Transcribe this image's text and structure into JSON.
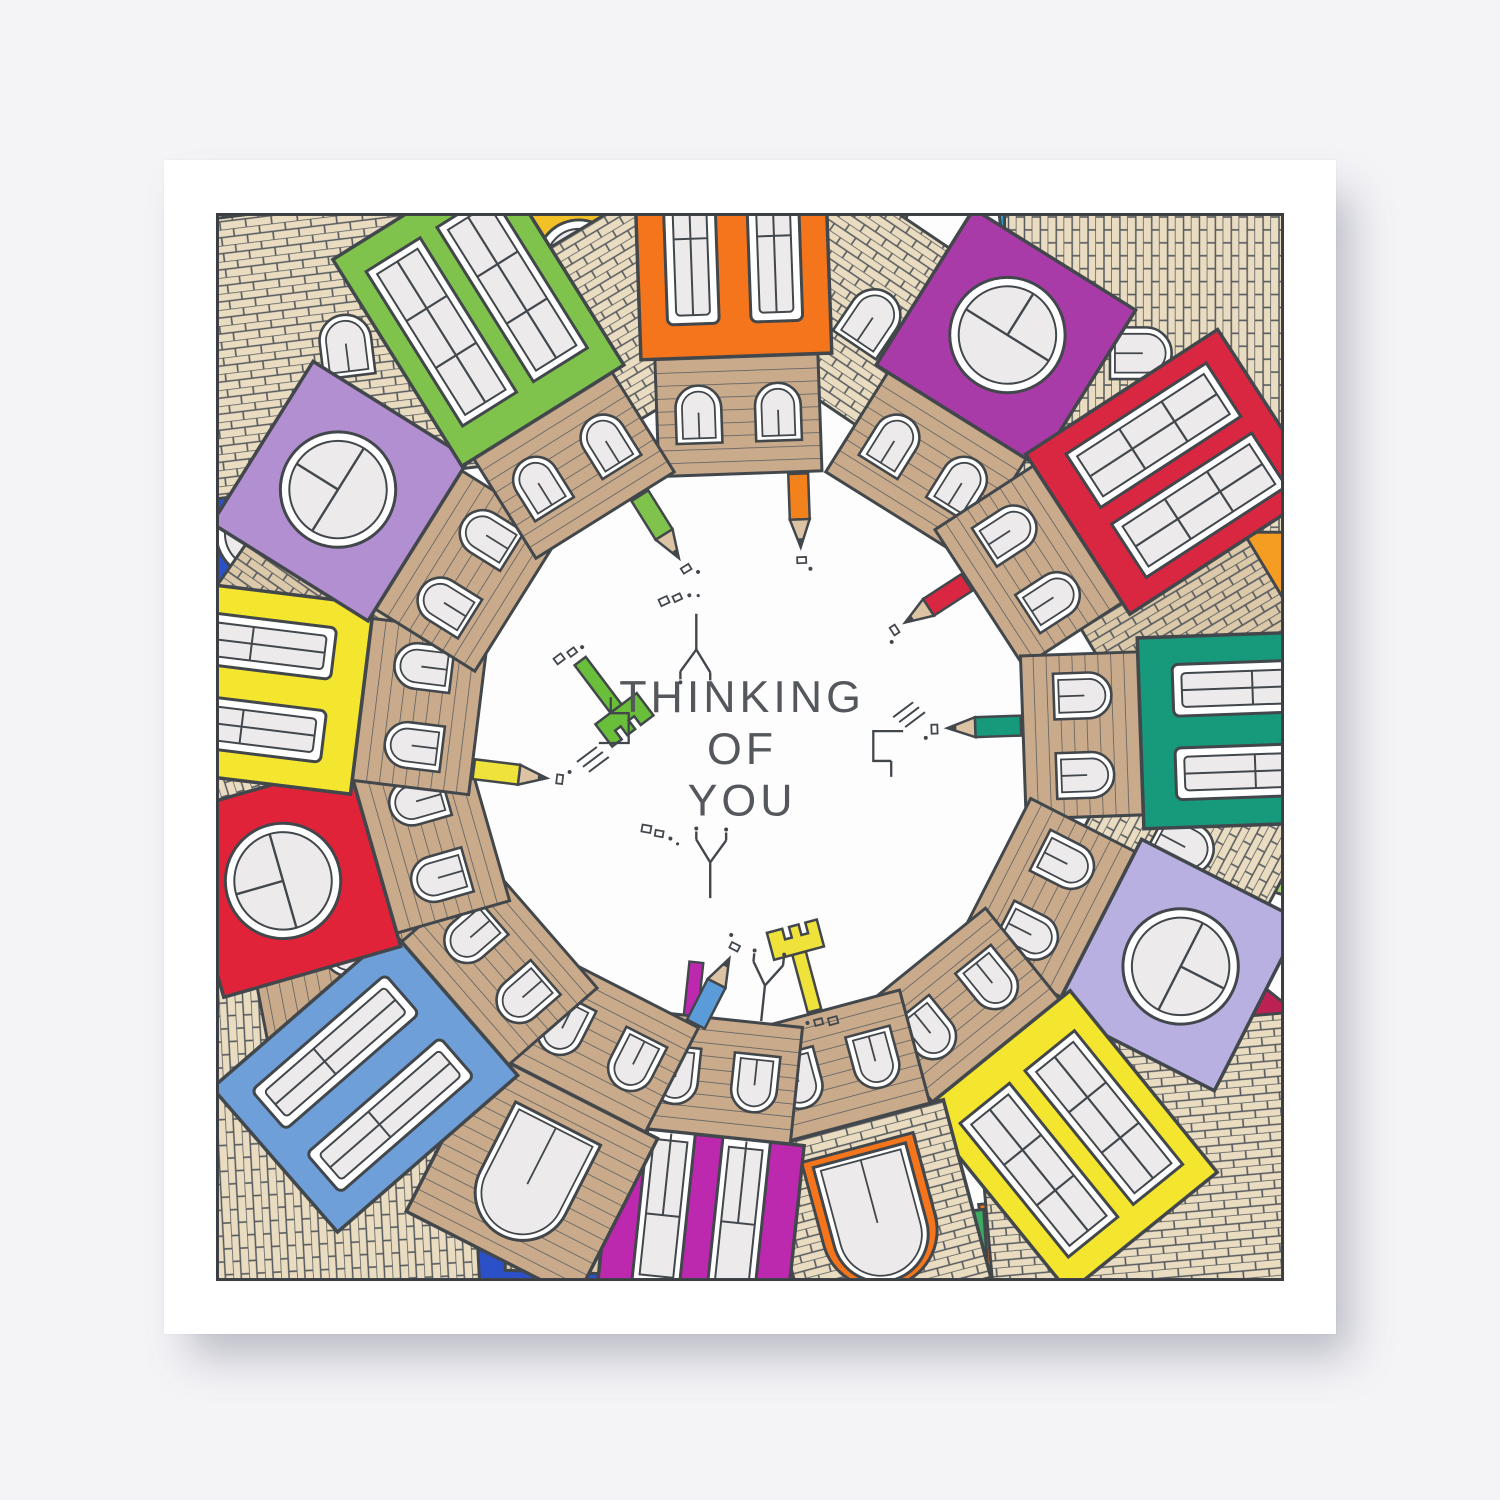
{
  "photo": {
    "background": "#f4f4f7",
    "card_color": "#ffffff"
  },
  "card": {
    "border_color": "#3a3e42",
    "paper": "#fdfdfe",
    "message": {
      "line1": "THINKING",
      "line2": "OF",
      "line3": "YOU",
      "color": "#54575b"
    },
    "palette": {
      "ink": "#42474c",
      "glass": "#edeaec",
      "frame": "#ffffff",
      "brick_fill": "#e9dcc0",
      "brick_fill_2": "#dcc9a9",
      "slat_fill": "#c9ab8b",
      "pencil_wood": "#dcc3a4"
    },
    "houses": [
      {
        "name": "orange-house-top",
        "angle": 358,
        "facade": "#f4751c",
        "style": "tall2",
        "flen": 210,
        "doodle": "pencil",
        "doodle_color": "#f4821c",
        "doodle_dx": 58
      },
      {
        "name": "purple-house-top-right",
        "angle": 32,
        "facade": "#a93ba8",
        "style": "round",
        "flen": 185
      },
      {
        "name": "red-house-top-right",
        "angle": 57,
        "facade": "#d92641",
        "style": "grid",
        "flen": 230,
        "doodle": "pencil",
        "doodle_color": "#d92641",
        "doodle_dx": -20
      },
      {
        "name": "teal-house-right",
        "angle": 88,
        "facade": "#17997c",
        "style": "tall2",
        "flen": 200,
        "doodle": "pencil",
        "doodle_color": "#17997c",
        "doodle_dx": -12
      },
      {
        "name": "lavender-house-right",
        "angle": 117,
        "facade": "#b7b0e0",
        "style": "round",
        "flen": 180
      },
      {
        "name": "yellow-house-bottom-right",
        "angle": 141,
        "facade": "#f4e52f",
        "style": "grid",
        "flen": 235
      },
      {
        "name": "tan-house-bottom",
        "angle": 165,
        "facade": "brick",
        "style": "arch",
        "arch_color": "#f4751c",
        "flen": 185,
        "doodle": "key",
        "doodle_color": "#efe23b",
        "doodle_dx": 6
      },
      {
        "name": "magenta-house-bottom",
        "angle": 186,
        "facade": "#bd29ae",
        "style": "doors",
        "flen": 195,
        "doodle": "antenna",
        "doodle_dx": -40,
        "chimney": "#bd29ae"
      },
      {
        "name": "slat-house-bottom-left",
        "angle": 207,
        "facade": "slats",
        "style": "arch",
        "flen": 180,
        "doodle": "pencil",
        "doodle_color": "#5b9bd8",
        "doodle_dx": -78
      },
      {
        "name": "blue-house-bottom-left",
        "angle": 229,
        "facade": "#6f9fd8",
        "style": "tall2",
        "flen": 240
      },
      {
        "name": "red-house-left",
        "angle": 254,
        "facade": "#e02339",
        "style": "round",
        "flen": 185
      },
      {
        "name": "yellow-house-left",
        "angle": 277,
        "facade": "#f4e52f",
        "style": "tall2",
        "flen": 205,
        "doodle": "pencil",
        "doodle_color": "#efe23b",
        "doodle_dx": -56
      },
      {
        "name": "lilac-house-left",
        "angle": 302,
        "facade": "#b28fd0",
        "style": "round",
        "flen": 185
      },
      {
        "name": "green-house-top-left",
        "angle": 328,
        "facade": "#7fc24c",
        "style": "grid",
        "flen": 245,
        "doodle": "pencil",
        "doodle_color": "#7fc24c",
        "doodle_dx": 40
      }
    ],
    "roofs": [
      {
        "angle": 16,
        "dist": 450,
        "w": 230,
        "h": 200,
        "tilt": 18,
        "pattern": "brick",
        "dormer": true
      },
      {
        "angle": 45,
        "dist": 560,
        "w": 360,
        "h": 280,
        "tilt": 45,
        "pattern": "brick",
        "dormer": true
      },
      {
        "angle": 73,
        "dist": 455,
        "w": 220,
        "h": 190,
        "tilt": -14,
        "pattern": "brickv",
        "dormer": false
      },
      {
        "angle": 103,
        "dist": 450,
        "w": 230,
        "h": 200,
        "tilt": 15,
        "pattern": "brick",
        "dormer": true
      },
      {
        "angle": 130,
        "dist": 455,
        "w": 220,
        "h": 190,
        "tilt": -16,
        "pattern": "slats",
        "dormer": false
      },
      {
        "angle": 135,
        "dist": 585,
        "w": 360,
        "h": 270,
        "tilt": 40,
        "pattern": "brick",
        "dormer": false
      },
      {
        "angle": 176,
        "dist": 450,
        "w": 240,
        "h": 200,
        "tilt": 14,
        "pattern": "brick",
        "dormer": true
      },
      {
        "angle": 197,
        "dist": 455,
        "w": 220,
        "h": 190,
        "tilt": -15,
        "pattern": "brickv",
        "dormer": true
      },
      {
        "angle": 225,
        "dist": 585,
        "w": 360,
        "h": 270,
        "tilt": 42,
        "pattern": "brick",
        "dormer": false
      },
      {
        "angle": 243,
        "dist": 450,
        "w": 230,
        "h": 200,
        "tilt": 16,
        "pattern": "slats",
        "dormer": true
      },
      {
        "angle": 266,
        "dist": 455,
        "w": 220,
        "h": 190,
        "tilt": -14,
        "pattern": "brick",
        "dormer": true
      },
      {
        "angle": 290,
        "dist": 450,
        "w": 230,
        "h": 195,
        "tilt": 15,
        "pattern": "brickv",
        "dormer": false
      },
      {
        "angle": 315,
        "dist": 575,
        "w": 360,
        "h": 280,
        "tilt": 38,
        "pattern": "brick",
        "dormer": true
      },
      {
        "angle": 344,
        "dist": 452,
        "w": 225,
        "h": 195,
        "tilt": -15,
        "pattern": "brick",
        "dormer": false
      }
    ],
    "patches": [
      {
        "name": "teal-patch-top",
        "color": "#16a07a",
        "points": "120,0 300,0 270,85 140,70"
      },
      {
        "name": "gold-house-top",
        "color": "#f2c027",
        "points": "280,0 455,0 432,128 298,112",
        "window": {
          "type": "round",
          "x": 368,
          "y": 52,
          "r": 42
        }
      },
      {
        "name": "lightgreen-sliver-top",
        "color": "#b5d96a",
        "points": "600,0 700,0 680,55 605,50"
      },
      {
        "name": "blue-patch-top-right",
        "color": "#2e9ed1",
        "points": "790,0 995,0 965,95 800,80"
      },
      {
        "name": "orange-patch-right",
        "color": "#f59d22",
        "points": "1080,290 1080,420 1000,400 1010,300"
      },
      {
        "name": "pink-house-right",
        "color": "#f2a0b8",
        "points": "1080,420 1080,590 985,560 995,430",
        "window": {
          "type": "round",
          "x": 1040,
          "y": 495,
          "r": 42
        }
      },
      {
        "name": "lightgreen-patch-right",
        "color": "#a8d66e",
        "points": "1080,595 1080,690 1005,665 1010,600"
      },
      {
        "name": "crimson-house-bottom-right",
        "color": "#bb2153",
        "points": "880,790 1030,760 1080,800 1080,990 950,1000",
        "window": {
          "type": "arch",
          "x": 985,
          "y": 900,
          "rot": -40
        }
      },
      {
        "name": "orange-house-bottom",
        "color": "#f4751c",
        "points": "770,1000 930,985 950,1080 780,1080",
        "window": {
          "type": "arch",
          "x": 860,
          "y": 1062,
          "rot": 0
        }
      },
      {
        "name": "green-patch-bottom",
        "color": "#3cab62",
        "points": "690,1015 775,1005 780,1080 695,1080"
      },
      {
        "name": "red-patch-bottom",
        "color": "#e8311f",
        "points": "355,1005 480,1010 470,1080 360,1080"
      },
      {
        "name": "lightgreen-house-bottom",
        "color": "#a8d66e",
        "points": "215,985 355,1000 350,1080 220,1080",
        "window": {
          "type": "arch",
          "x": 285,
          "y": 1062,
          "rot": 0
        }
      },
      {
        "name": "royalblue-patch-bottom-left",
        "color": "#2b50c8",
        "points": "262,1012 420,1015 415,1080 268,1080"
      },
      {
        "name": "orange-house-bottom-left",
        "color": "#f59d22",
        "points": "95,1002 235,1008 228,1080 100,1080",
        "window": {
          "type": "arch",
          "x": 165,
          "y": 1062,
          "rot": 0
        }
      },
      {
        "name": "pink-patch-bottom-left",
        "color": "#f2a0b8",
        "points": "0,820 95,835 88,955 0,962"
      },
      {
        "name": "orange-sliver-left",
        "color": "#f4751c",
        "points": "0,378 48,384 42,470 0,466"
      },
      {
        "name": "royalblue-house-left",
        "color": "#2b50c8",
        "points": "0,235 130,255 112,430 0,420",
        "window": {
          "type": "round",
          "x": 48,
          "y": 325,
          "r": 45
        }
      }
    ],
    "doodles": [
      {
        "type": "key",
        "name": "green-key",
        "x": 368,
        "y": 452,
        "rot": -37,
        "color": "#6abf3a"
      },
      {
        "type": "antenna",
        "name": "tv-aerial-top",
        "x": 486,
        "y": 404,
        "rot": 0
      },
      {
        "type": "bracket",
        "name": "circuit-doodle-left",
        "x": 388,
        "y": 536,
        "rot": 0
      },
      {
        "type": "bracket",
        "name": "circuit-doodle-right",
        "x": 694,
        "y": 524,
        "rot": 180
      },
      {
        "type": "antenna",
        "name": "tv-aerial-bottom",
        "x": 500,
        "y": 694,
        "rot": 180
      },
      {
        "type": "dots",
        "name": "dot-trail-left",
        "x": 432,
        "y": 618,
        "rot": 10
      },
      {
        "type": "dots",
        "name": "dot-trail-top",
        "x": 448,
        "y": 392,
        "rot": -25
      }
    ]
  }
}
